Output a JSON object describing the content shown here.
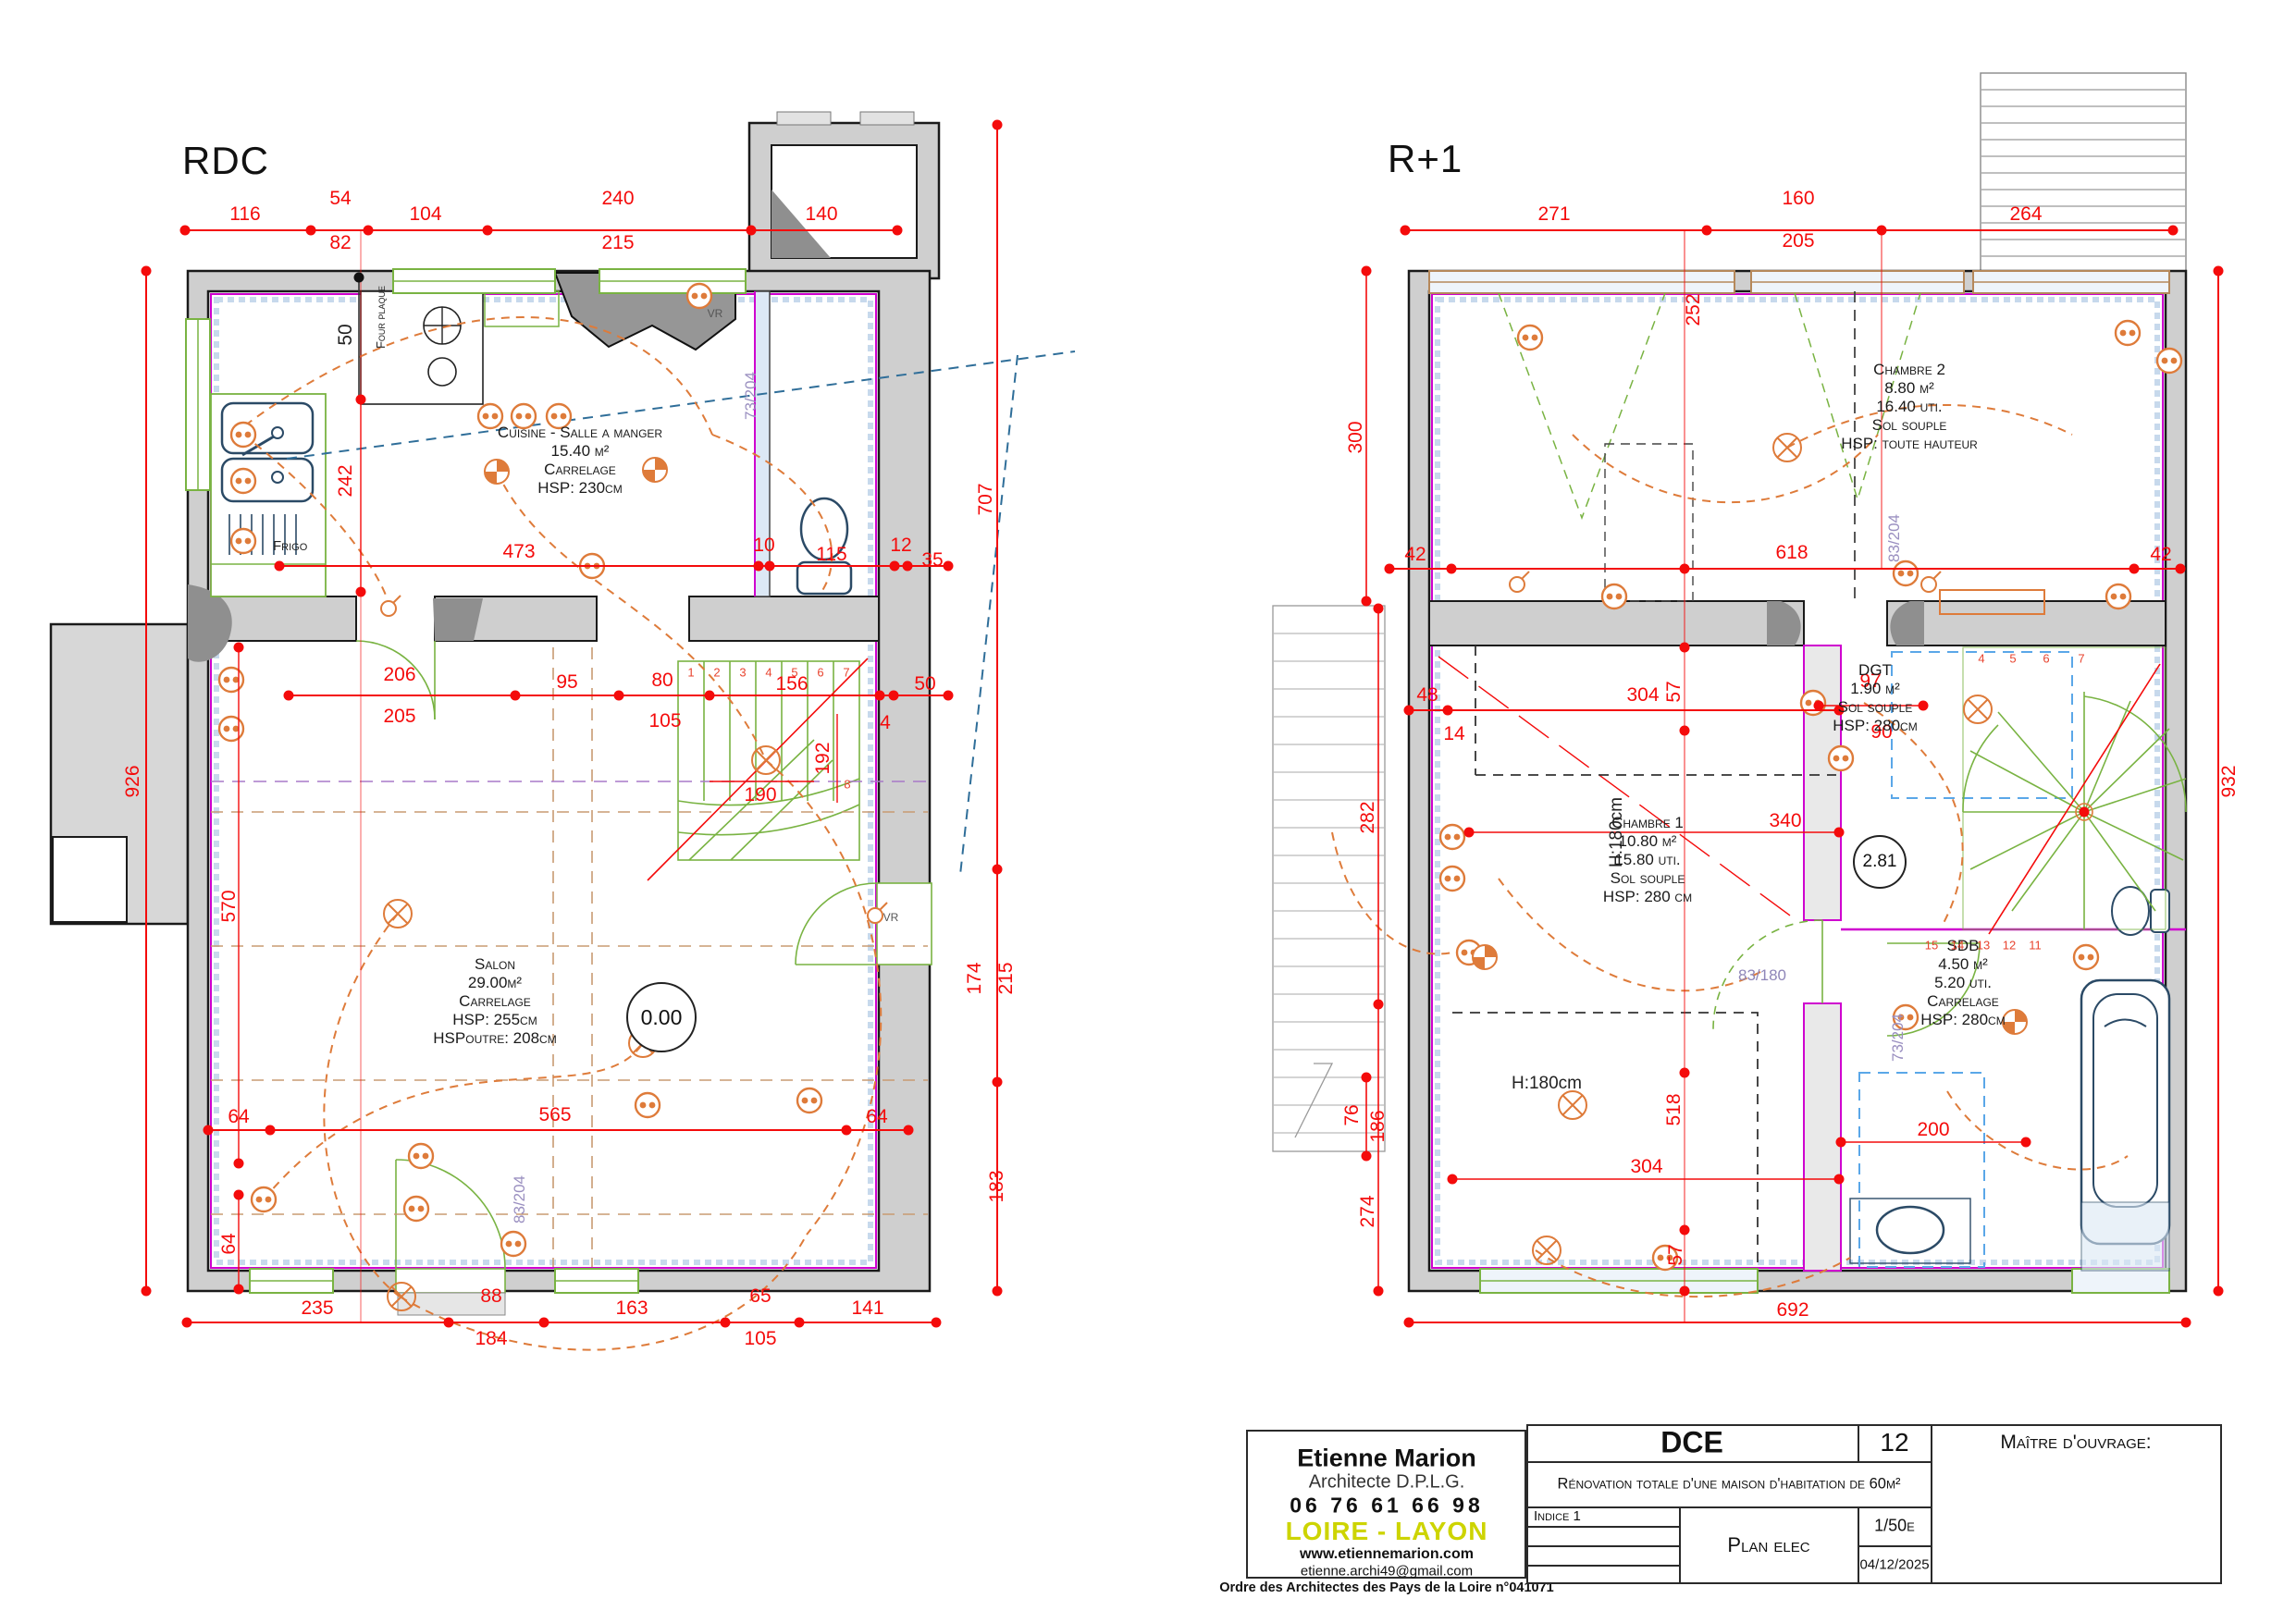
{
  "colors": {
    "dim_red": "#f40b0b",
    "circuit_orange": "#de7b3a",
    "cad_green": "#79b342",
    "magenta": "#cf00cf",
    "hatch_blue": "#c7d9ec",
    "wall_gray": "#cfcfcf",
    "poche_gray": "#8f8f8f",
    "logo_yellow": "#cdd400",
    "tan": "#c89b72"
  },
  "rdc": {
    "title": "RDC",
    "level": "0.00",
    "rooms": {
      "cuisine": {
        "name": "Cuisine - Salle a manger",
        "area": "15.40 m²",
        "floor": "Carrelage",
        "height": "HSP: 230cm"
      },
      "salon": {
        "name": "Salon",
        "area": "29.00m²",
        "floor": "Carrelage",
        "height": "HSP: 255cm",
        "beam": "HSPoutre: 208cm"
      }
    },
    "labels": {
      "frigo": "Frigo",
      "four": "Four plaque",
      "vr_top": "VR",
      "vr_right": "VR",
      "door_a": "73/204",
      "door_b": "83/204"
    },
    "dims": {
      "top": [
        "116",
        "54",
        "82",
        "104",
        "240",
        "215",
        "140"
      ],
      "kitchen": [
        "473",
        "10",
        "115",
        "12",
        "35"
      ],
      "mid": [
        "206",
        "205",
        "95",
        "80",
        "105",
        "156",
        "4",
        "50"
      ],
      "stair": [
        "190",
        "192"
      ],
      "lower": [
        "64",
        "565",
        "64"
      ],
      "bottom": [
        "235",
        "88",
        "184",
        "163",
        "65",
        "105",
        "141"
      ],
      "left": [
        "926",
        "242",
        "570",
        "64",
        "50"
      ],
      "right": [
        "707",
        "174",
        "215",
        "183"
      ]
    },
    "stairs": [
      "1",
      "2",
      "3",
      "4",
      "5",
      "6",
      "7",
      "8"
    ]
  },
  "r1": {
    "title": "R+1",
    "level": "2.81",
    "rooms": {
      "chambre2": {
        "name": "Chambre 2",
        "area": "8.80 m²",
        "uti": "16.40 uti.",
        "floor": "Sol souple",
        "height": "HSP: toute hauteur"
      },
      "chambre1": {
        "name": "Chambre 1",
        "area": "10.80 m²",
        "uti": "15.80 uti.",
        "floor": "Sol souple",
        "height": "HSP: 280 cm"
      },
      "dgt": {
        "name": "DGT",
        "area": "1.90 m²",
        "floor": "Sol souple",
        "height": "HSP: 280cm"
      },
      "sdb": {
        "name": "SDB",
        "area": "4.50 m²",
        "uti": "5.20 uti.",
        "floor": "Carrelage",
        "height": "HSP: 280cm"
      }
    },
    "labels": {
      "h180_upper": "H:180cm",
      "h180_lower": "H:180cm",
      "door_a": "83/180",
      "door_b": "73/204",
      "door_c": "83/204"
    },
    "dims": {
      "top": [
        "271",
        "160",
        "205",
        "264"
      ],
      "upper": [
        "42",
        "618",
        "42"
      ],
      "mid": [
        "57",
        "97",
        "90",
        "48",
        "14",
        "304",
        "340",
        "252"
      ],
      "lower": [
        "518",
        "304",
        "57",
        "200"
      ],
      "left": [
        "300",
        "282",
        "76",
        "186",
        "274"
      ],
      "right": [
        "932"
      ],
      "bottom": [
        "692"
      ]
    },
    "stairs_top": [
      "4",
      "5",
      "6",
      "7"
    ],
    "stairs_left": [
      "15",
      "14",
      "13",
      "12",
      "11"
    ]
  },
  "titleblock": {
    "architect": {
      "name": "Etienne Marion",
      "title": "Architecte D.P.L.G.",
      "phone": "06 76 61 66 98",
      "region": "LOIRE - LAYON",
      "website": "www.etiennemarion.com",
      "email": "etienne.archi49@gmail.com",
      "ordre": "Ordre des Architectes des Pays de la Loire n°041071"
    },
    "phase": "DCE",
    "sheet_number": "12",
    "project": "Rénovation totale d'une maison d'habitation de 60m²",
    "indice": "Indice 1",
    "sheet_name": "Plan elec",
    "scale": "1/50e",
    "date": "04/12/2025",
    "owner_label": "Maître d'ouvrage:"
  }
}
